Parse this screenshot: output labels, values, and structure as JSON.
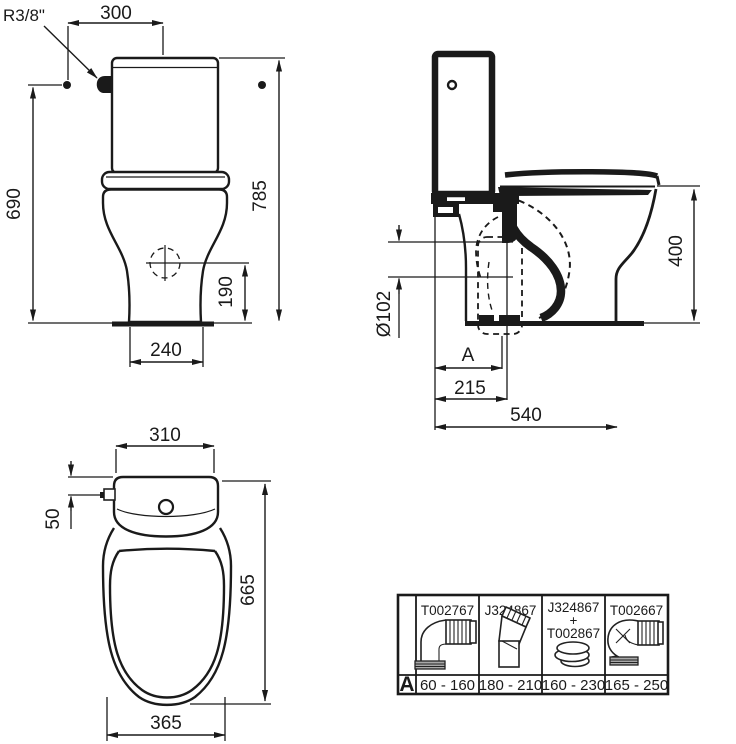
{
  "drawing_title": "WC close coupled - technical dimensions",
  "colors": {
    "line": "#1a1a1a",
    "background": "#ffffff"
  },
  "front_view": {
    "supply_connection": "R3/8\"",
    "dim_supply_to_center": "300",
    "dim_total_height": "785",
    "dim_supply_height": "690",
    "dim_inlet_height": "190",
    "dim_base_width": "240"
  },
  "side_view": {
    "dim_seat_height": "400",
    "dim_outlet_diameter": "Ø102",
    "dim_variable_setout": "A",
    "dim_wall_to_outlet": "215",
    "dim_total_depth": "540"
  },
  "top_view": {
    "dim_cistern_width": "310",
    "dim_supply_offset": "50",
    "dim_total_depth": "665",
    "dim_bowl_width": "365"
  },
  "accessories_table": {
    "row_label": "A",
    "columns": [
      {
        "code_lines": [
          "T002767"
        ],
        "range": "60 - 160",
        "icon": "pan-connector-elbow-icon"
      },
      {
        "code_lines": [
          "J324867"
        ],
        "range": "180 - 210",
        "icon": "pan-connector-offset-icon"
      },
      {
        "code_lines": [
          "J324867",
          "+",
          "T002867"
        ],
        "range": "160 - 230",
        "icon": "pan-connector-seal-icon"
      },
      {
        "code_lines": [
          "T002667"
        ],
        "range": "165 - 250",
        "icon": "pan-connector-long-elbow-icon"
      }
    ]
  }
}
